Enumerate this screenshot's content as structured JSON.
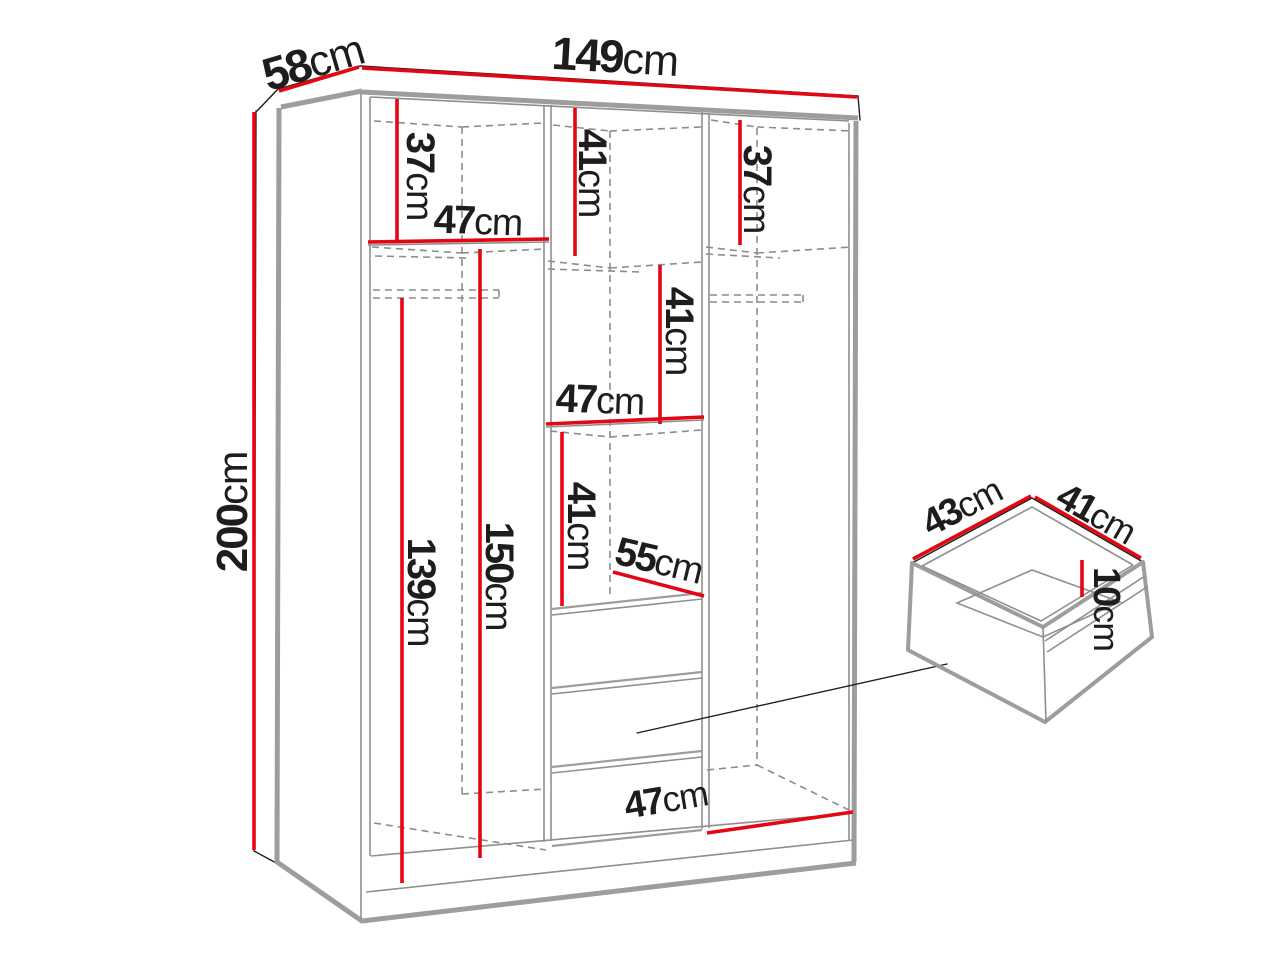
{
  "colors": {
    "dimension_red": "#e30613",
    "panel_gray": "#9d9d9c",
    "outline_dark": "#1d1d1b",
    "background": "#ffffff"
  },
  "wardrobe": {
    "overall": {
      "depth": {
        "value": "58",
        "unit": "cm"
      },
      "width": {
        "value": "149",
        "unit": "cm"
      },
      "height": {
        "value": "200",
        "unit": "cm"
      }
    },
    "left": {
      "top_height": {
        "value": "37",
        "unit": "cm"
      },
      "width": {
        "value": "47",
        "unit": "cm"
      },
      "rod_height": {
        "value": "139",
        "unit": "cm"
      },
      "interior_height": {
        "value": "150",
        "unit": "cm"
      }
    },
    "middle": {
      "top_height": {
        "value": "41",
        "unit": "cm"
      },
      "second_height": {
        "value": "41",
        "unit": "cm"
      },
      "width": {
        "value": "47",
        "unit": "cm"
      },
      "third_height": {
        "value": "41",
        "unit": "cm"
      },
      "depth": {
        "value": "55",
        "unit": "cm"
      }
    },
    "right": {
      "top_height": {
        "value": "37",
        "unit": "cm"
      },
      "bottom_width": {
        "value": "47",
        "unit": "cm"
      }
    }
  },
  "drawer": {
    "depth": {
      "value": "43",
      "unit": "cm"
    },
    "width": {
      "value": "41",
      "unit": "cm"
    },
    "height": {
      "value": "10",
      "unit": "cm"
    }
  }
}
